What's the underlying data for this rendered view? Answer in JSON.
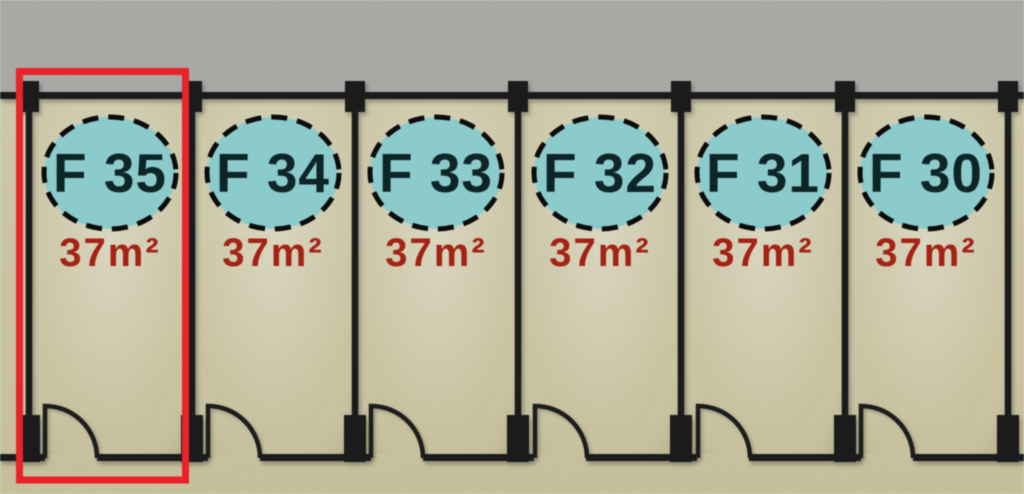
{
  "plan": {
    "highlighted_unit": "F 35",
    "units": [
      {
        "label": "F 35",
        "area": "37m²",
        "highlighted": true
      },
      {
        "label": "F 34",
        "area": "37m²",
        "highlighted": false
      },
      {
        "label": "F 33",
        "area": "37m²",
        "highlighted": false
      },
      {
        "label": "F 32",
        "area": "37m²",
        "highlighted": false
      },
      {
        "label": "F 31",
        "area": "37m²",
        "highlighted": false
      },
      {
        "label": "F 30",
        "area": "37m²",
        "highlighted": false
      }
    ]
  },
  "colors": {
    "background_gray": "#e2e1de",
    "floor_cream": "#ece5bf",
    "wall_black": "#1b1b1b",
    "badge_teal": "#8ccbcb",
    "unit_number_text": "#0e2527",
    "area_text": "#a32314",
    "highlight_red": "#ea2328"
  }
}
